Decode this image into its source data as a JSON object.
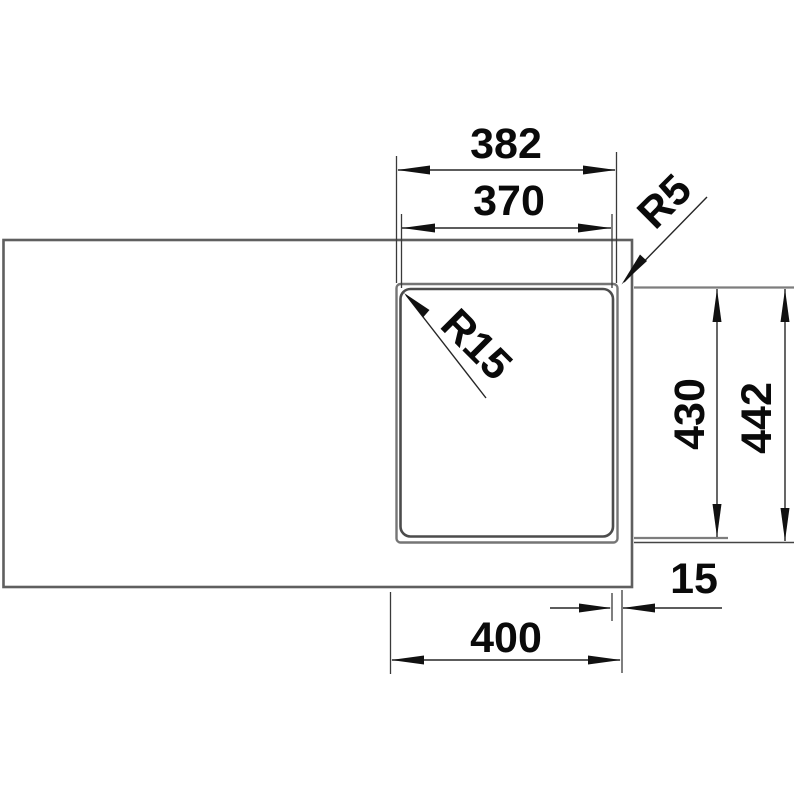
{
  "drawing": {
    "type": "sink-cutout-technical-drawing",
    "top_dimensions": {
      "outer_width": "382",
      "bowl_width": "370"
    },
    "radii": {
      "outer_corner": "R5",
      "bowl_corner": "R15"
    },
    "side_dimensions": {
      "bowl_length": "430",
      "outer_length": "442"
    },
    "bottom_dimensions": {
      "edge_gap": "15",
      "cutout_width": "400"
    },
    "colors": {
      "background": "#ffffff",
      "countertop_outline": "#5f5f5f",
      "flange_outline": "#757575",
      "bowl_outline": "#4c4c4c",
      "extension_heavy": "#7d7d7d",
      "dim_line": "#262626",
      "arrow_fill": "#111111",
      "text": "#0a0a0a"
    }
  }
}
